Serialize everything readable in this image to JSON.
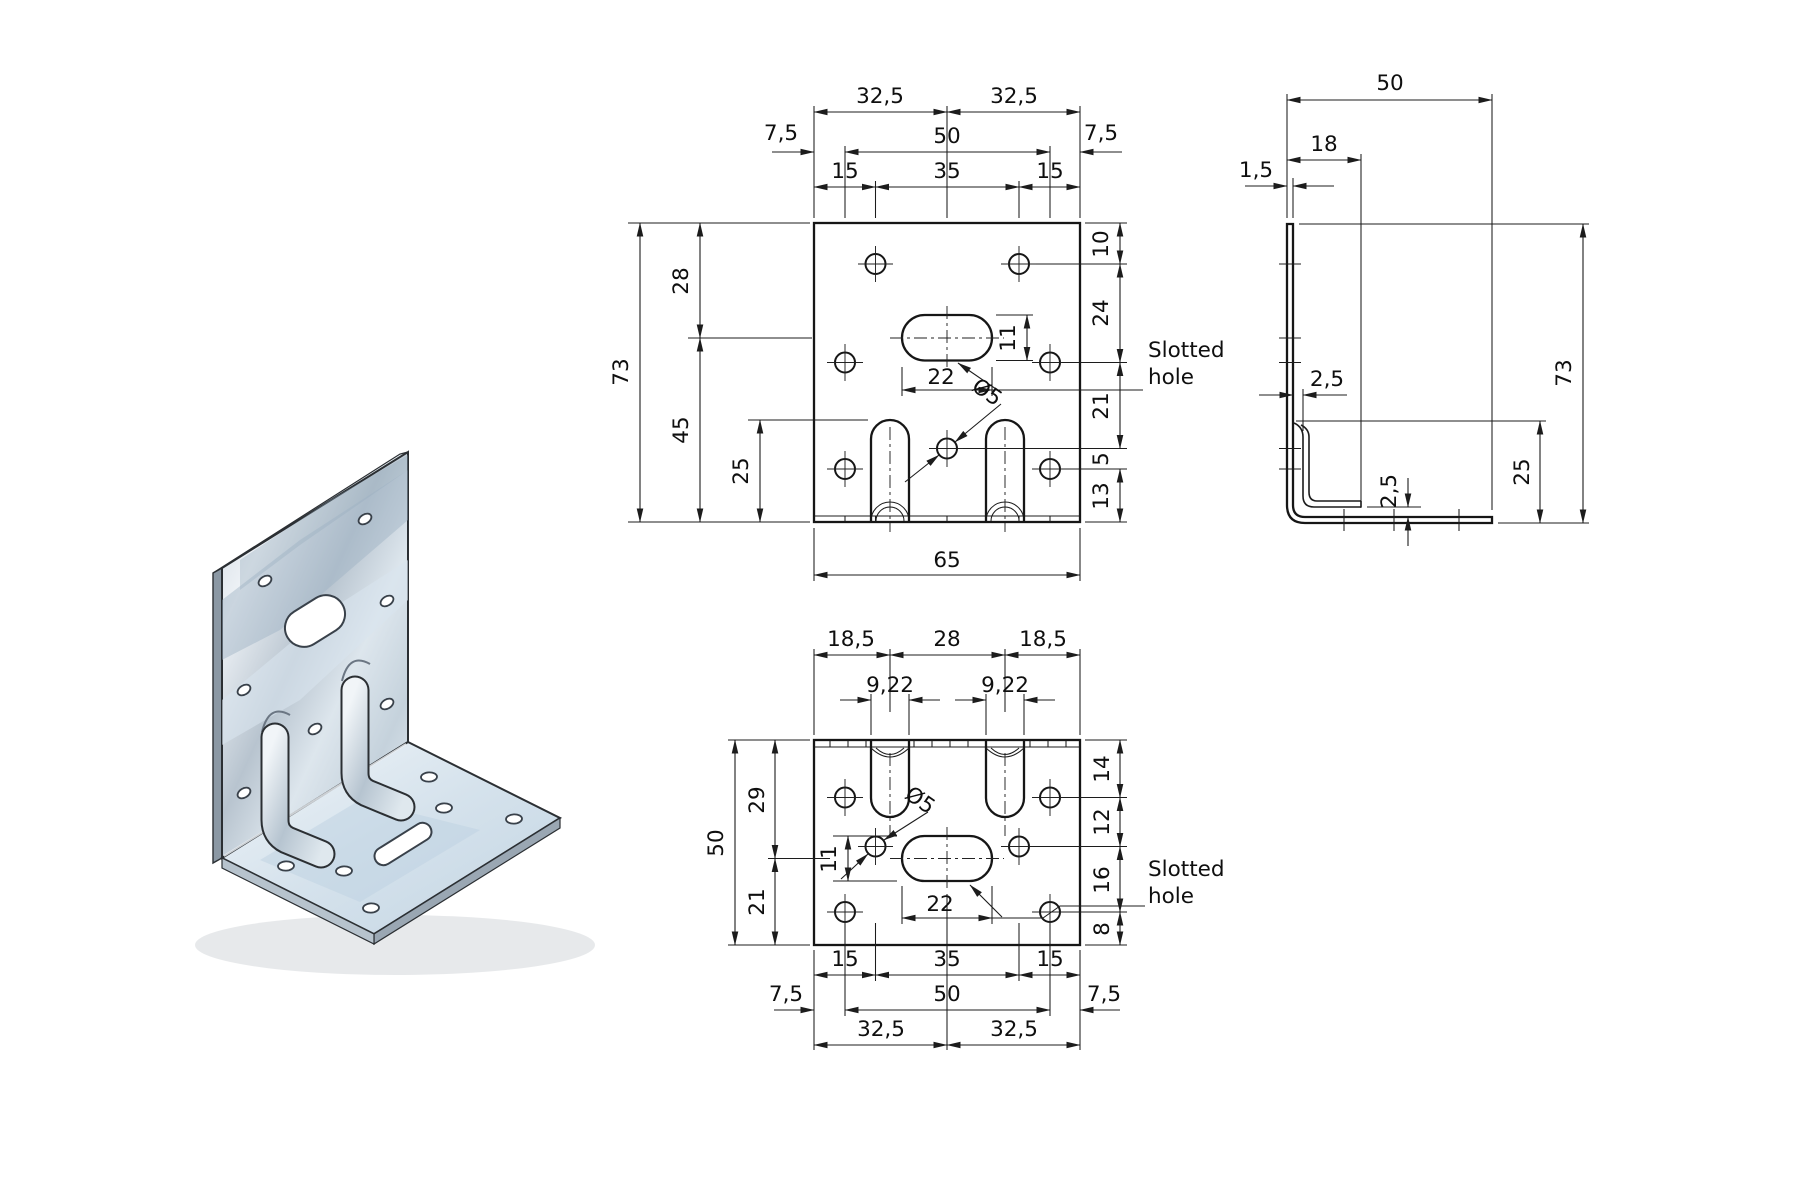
{
  "page": {
    "background": "#ffffff",
    "line_color": "#1c1c1c"
  },
  "front_view": {
    "top": {
      "d325l": "32,5",
      "d325r": "32,5",
      "d75l": "7,5",
      "d50": "50",
      "d75r": "7,5",
      "d15l": "15",
      "d35": "35",
      "d15r": "15"
    },
    "left": {
      "d73": "73",
      "d28": "28",
      "d45": "45",
      "d25": "25"
    },
    "right": {
      "d10": "10",
      "d24": "24",
      "d21": "21",
      "d5": "5",
      "d13": "13"
    },
    "inner": {
      "d11": "11",
      "d22": "22",
      "dia": "Ø5"
    },
    "bottom": {
      "d65": "65"
    },
    "slotted_hole": {
      "line1": "Slotted",
      "line2": "hole"
    }
  },
  "side_view": {
    "d50": "50",
    "d18": "18",
    "d15": "1,5",
    "d25_offset": "2,5",
    "d25_bottom": "2,5",
    "d25_leg": "25",
    "d73": "73"
  },
  "bottom_view": {
    "top": {
      "d185l": "18,5",
      "d28": "28",
      "d185r": "18,5",
      "d922l": "9,22",
      "d922r": "9,22"
    },
    "left": {
      "d50": "50",
      "d29": "29",
      "d21": "21"
    },
    "right": {
      "d14": "14",
      "d12": "12",
      "d16": "16",
      "d8": "8"
    },
    "inner": {
      "d11": "11",
      "d22": "22",
      "dia": "Ø5"
    },
    "bottom": {
      "d15l": "15",
      "d35": "35",
      "d15r": "15",
      "d75l": "7,5",
      "d50": "50",
      "d75r": "7,5",
      "d325l": "32,5",
      "d325r": "32,5"
    },
    "slotted_hole": {
      "line1": "Slotted",
      "line2": "hole"
    }
  }
}
